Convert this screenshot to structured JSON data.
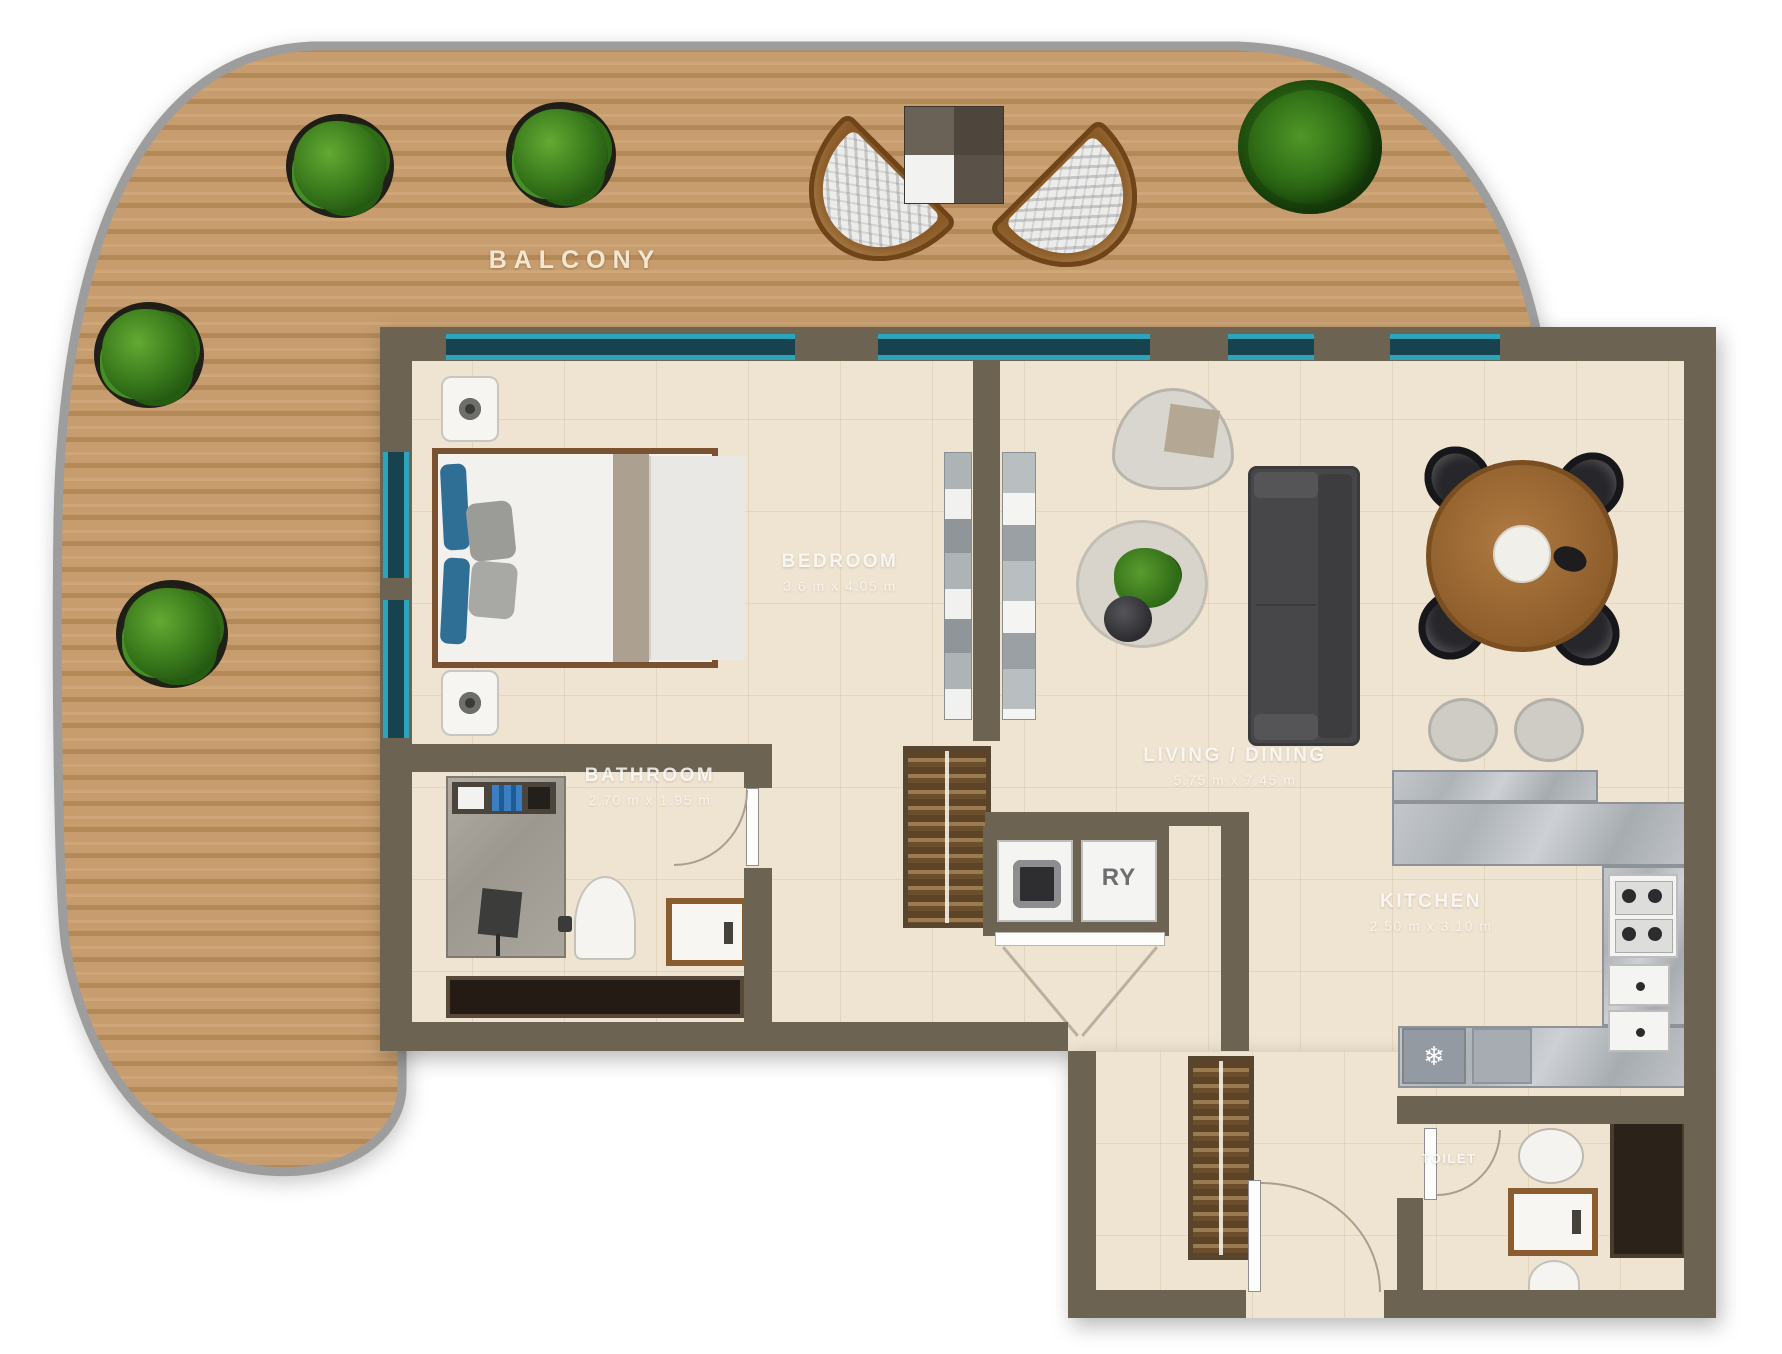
{
  "balcony": {
    "label": "BALCONY"
  },
  "rooms": {
    "bedroom": {
      "name": "BEDROOM",
      "dims": "3.6 m x 4.05 m"
    },
    "bathroom": {
      "name": "BATHROOM",
      "dims": "2.70 m x 1.95 m"
    },
    "living": {
      "name": "LIVING / DINING",
      "dims": "5.75 m x 7.45 m"
    },
    "kitchen": {
      "name": "KITCHEN",
      "dims": "2.50 m x 3.10 m"
    },
    "toilet": {
      "name": "TOILET"
    }
  },
  "laundry": {
    "dryer_text": "RY"
  },
  "kitchen_icons": {
    "freezer_icon": "❄"
  },
  "colors": {
    "deck_wood": "#c79d6f",
    "outline_gray": "#9d9d9d",
    "wall": "#6d6353",
    "floor": "#efe3d1",
    "window_teal": "#2ba4bc",
    "window_dark": "#17424e",
    "sofa": "#4a4a4c",
    "dining_table": "#9c6b38",
    "plant_green": "#3d7a22",
    "pillow_blue": "#2f6f96"
  }
}
